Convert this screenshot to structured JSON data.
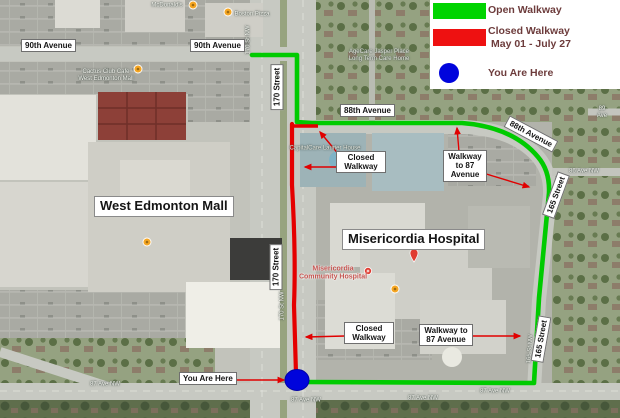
{
  "legend": {
    "open_label": "Open Walkway",
    "closed_label": "Closed Walkway",
    "closed_dates": "May 01 - July 27",
    "here_label": "You Are Here",
    "colors": {
      "open": "#00d400",
      "closed": "#ee1111",
      "marker": "#0000e0",
      "text": "#6d3c3c"
    }
  },
  "callouts": {
    "ave90_left": "90th Avenue",
    "ave90_mid": "90th Avenue",
    "st170_top": "170 Street",
    "st170_bottom": "170 Street",
    "ave88_horizontal": "88th Avenue",
    "ave88_rotated": "88th Avenue",
    "st165_top": "165 Street",
    "st165_bottom": "165 Street",
    "west_edmonton_mall": "West Edmonton Mall",
    "misericordia_hospital": "Misericordia Hospital",
    "closed_walkway_top": "Closed\nWalkway",
    "closed_walkway_bottom": "Closed\nWalkway",
    "walkway_87_top": "Walkway\nto 87\nAvenue",
    "walkway_87_bottom": "Walkway to\n87 Avenue",
    "you_are_here": "You Are Here"
  },
  "poi": {
    "mcdonalds": "McDonald's",
    "boston_pizza": "Boston Pizza",
    "cactus_club": "Cactus Club Cafe\nWest Edmonton Mall",
    "care_home": "AgeCare Jasper Place\nLong Term Care Home",
    "laurier_house": "CapitalCare Laurier House",
    "misericordia_community": "Misericordia\nCommunity Hospital"
  },
  "streets": {
    "ave87_1": "87 Ave NW",
    "ave87_2": "87 Ave NW",
    "ave87_3": "87 Ave NW",
    "ave87_4": "87 Ave NW",
    "st170_1": "170 St NW",
    "st170_2": "170 St NW",
    "st165": "165 St NW",
    "ave86": "86 Ave NW",
    "ave89": "89 Ave"
  }
}
